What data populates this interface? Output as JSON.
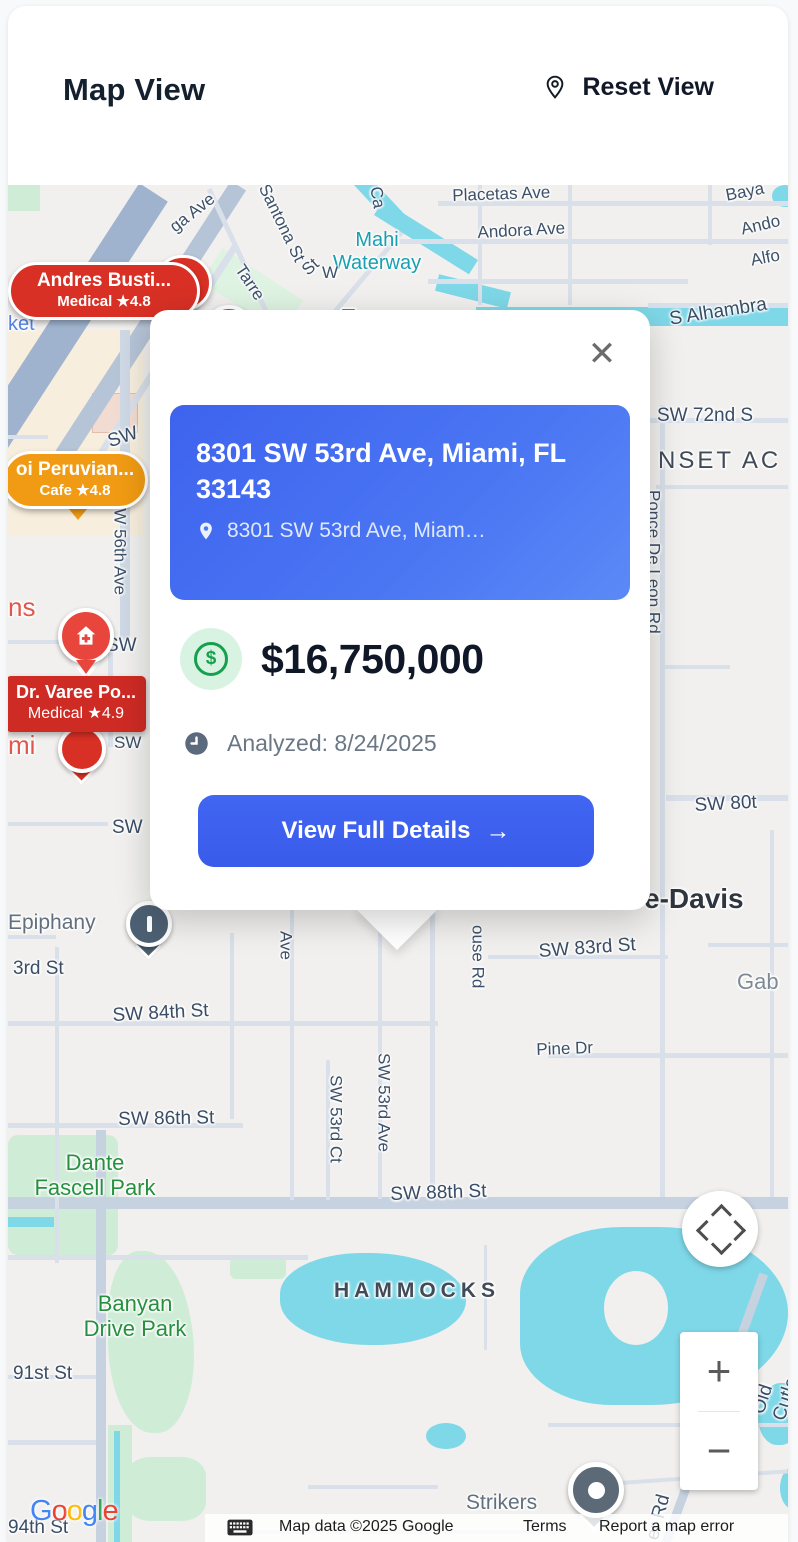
{
  "header": {
    "title": "Map View",
    "reset_view": "Reset View"
  },
  "popup": {
    "title": "8301 SW 53rd Ave, Miami, FL 33143",
    "address": "8301 SW 53rd Ave, Miam…",
    "price": "$16,750,000",
    "currency": "$",
    "analyzed": "Analyzed: 8/24/2025",
    "cta": "View Full Details",
    "arrow": "→",
    "close": "✕"
  },
  "markers": {
    "andres": {
      "name": "Andres Busti...",
      "meta": "Medical ★4.8"
    },
    "peruvian": {
      "name": "oi Peruvian...",
      "meta": "Cafe ★4.8"
    },
    "varee": {
      "name": "Dr. Varee Po...",
      "meta": "Medical ★4.9"
    }
  },
  "controls": {
    "zoom_in": "+",
    "zoom_out": "−"
  },
  "footer": {
    "google": "Google",
    "attribution": "Map data ©2025 Google",
    "terms": "Terms",
    "report": "Report a map error"
  },
  "colors": {
    "accent_blue": "#3e63ee",
    "marker_red": "#d93025",
    "marker_orange": "#f09b13",
    "price_green": "#16a04d",
    "water": "#7ed8e8",
    "park_green": "#27903f"
  },
  "map": {
    "labels": [
      {
        "t": "Placetas Ave",
        "x": 444,
        "y": 1,
        "r": -2,
        "c": "lbl-st"
      },
      {
        "t": "Andora Ave",
        "x": 469,
        "y": 38,
        "r": -3,
        "c": "lbl-st"
      },
      {
        "t": "Mahi\nWaterway",
        "x": 369,
        "y": 44,
        "r": 0,
        "c": "lbl-water",
        "ctr": true
      },
      {
        "t": "Baya",
        "x": 716,
        "y": 1,
        "r": -11,
        "c": "lbl-st"
      },
      {
        "t": "Ando",
        "x": 731,
        "y": 35,
        "r": -13,
        "c": "lbl-st"
      },
      {
        "t": "Alfo",
        "x": 741,
        "y": 66,
        "r": -11,
        "c": "lbl-st"
      },
      {
        "t": "S Alhambra",
        "x": 660,
        "y": 124,
        "r": -9,
        "c": "lbl-st-lg"
      },
      {
        "t": "SW 72nd S",
        "x": 649,
        "y": 220,
        "r": 0,
        "c": "lbl-st-lg"
      },
      {
        "t": "NSET AC",
        "x": 650,
        "y": 262,
        "r": 0,
        "c": "lbl-area"
      },
      {
        "t": "Ponce De Leon Rd",
        "x": 636,
        "y": 305,
        "r": 0,
        "c": "lbl-stv"
      },
      {
        "t": "Ca",
        "x": 377,
        "y": 0,
        "r": 80,
        "c": "lbl-st"
      },
      {
        "t": "Santona St",
        "x": 264,
        "y": -4,
        "r": 64,
        "c": "lbl-st"
      },
      {
        "t": "ga Ave",
        "x": 158,
        "y": 36,
        "r": -38,
        "c": "lbl-st"
      },
      {
        "t": "Tarre",
        "x": 239,
        "y": 76,
        "r": 56,
        "c": "lbl-st"
      },
      {
        "t": "St",
        "x": 290,
        "y": 80,
        "r": -42,
        "c": "lbl-st"
      },
      {
        "t": "W",
        "x": 314,
        "y": 78,
        "r": 0,
        "c": "lbl-st"
      },
      {
        "t": "ket",
        "x": 0,
        "y": 128,
        "r": 0,
        "c": "lbl-poi-blue"
      },
      {
        "t": "SW",
        "x": 97,
        "y": 247,
        "r": -18,
        "c": "lbl-st-lg"
      },
      {
        "t": "SW 56th Ave",
        "x": 102,
        "y": 312,
        "r": 0,
        "c": "lbl-stv"
      },
      {
        "t": "ns",
        "x": 0,
        "y": 408,
        "r": 0,
        "c": "lbl-poi-red"
      },
      {
        "t": "SW",
        "x": 98,
        "y": 450,
        "r": 0,
        "c": "lbl-st-lg"
      },
      {
        "t": "mi",
        "x": 0,
        "y": 546,
        "r": 0,
        "c": "lbl-poi-red"
      },
      {
        "t": "SW",
        "x": 106,
        "y": 548,
        "r": 0,
        "c": "lbl-st"
      },
      {
        "t": "SW",
        "x": 104,
        "y": 632,
        "r": 0,
        "c": "lbl-st-lg"
      },
      {
        "t": "SW 80t",
        "x": 686,
        "y": 610,
        "r": -3,
        "c": "lbl-st-lg"
      },
      {
        "t": "e-Davis",
        "x": 636,
        "y": 698,
        "r": 0,
        "c": "lbl-area-big"
      },
      {
        "t": "SW 83rd St",
        "x": 530,
        "y": 756,
        "r": -4,
        "c": "lbl-st-lg"
      },
      {
        "t": "Gab",
        "x": 729,
        "y": 784,
        "r": 0,
        "c": "lbl-poi22"
      },
      {
        "t": "Epiphany",
        "x": 0,
        "y": 726,
        "r": 0,
        "c": "lbl-poi"
      },
      {
        "t": "3rd St",
        "x": 5,
        "y": 773,
        "r": 0,
        "c": "lbl-st-lg"
      },
      {
        "t": "SW 84th St",
        "x": 104,
        "y": 820,
        "r": -3,
        "c": "lbl-st-lg"
      },
      {
        "t": "Ave",
        "x": 268,
        "y": 746,
        "r": 0,
        "c": "lbl-stv"
      },
      {
        "t": "ouse Rd",
        "x": 460,
        "y": 740,
        "r": 0,
        "c": "lbl-stv"
      },
      {
        "t": "Pine Dr",
        "x": 528,
        "y": 855,
        "r": -2,
        "c": "lbl-st"
      },
      {
        "t": "SW 86th St",
        "x": 110,
        "y": 924,
        "r": -1,
        "c": "lbl-st-lg"
      },
      {
        "t": "SW 53rd Ct",
        "x": 318,
        "y": 890,
        "r": 0,
        "c": "lbl-stv"
      },
      {
        "t": "SW 53rd Ave",
        "x": 366,
        "y": 868,
        "r": 0,
        "c": "lbl-stv"
      },
      {
        "t": "SW 88th St",
        "x": 382,
        "y": 999,
        "r": -2,
        "c": "lbl-st-lg"
      },
      {
        "t": "Dante\nFascell Park",
        "x": 87,
        "y": 965,
        "r": 0,
        "c": "lbl-park",
        "ctr": true
      },
      {
        "t": "HAMMOCKS",
        "x": 326,
        "y": 1094,
        "r": 0,
        "c": "lbl-area-sp"
      },
      {
        "t": "Banyan\nDrive Park",
        "x": 127,
        "y": 1106,
        "r": 0,
        "c": "lbl-park",
        "ctr": true
      },
      {
        "t": "91st St",
        "x": 5,
        "y": 1178,
        "r": 0,
        "c": "lbl-st-lg"
      },
      {
        "t": "Old Cutler",
        "x": 740,
        "y": 1225,
        "r": -72,
        "c": "lbl-st-lg"
      },
      {
        "t": "Strikers",
        "x": 458,
        "y": 1306,
        "r": 0,
        "c": "lbl-poi"
      },
      {
        "t": "er Rd",
        "x": 634,
        "y": 1352,
        "r": -75,
        "c": "lbl-st-lg"
      },
      {
        "t": "94th St",
        "x": 0,
        "y": 1332,
        "r": 0,
        "c": "lbl-st-lg"
      }
    ]
  }
}
